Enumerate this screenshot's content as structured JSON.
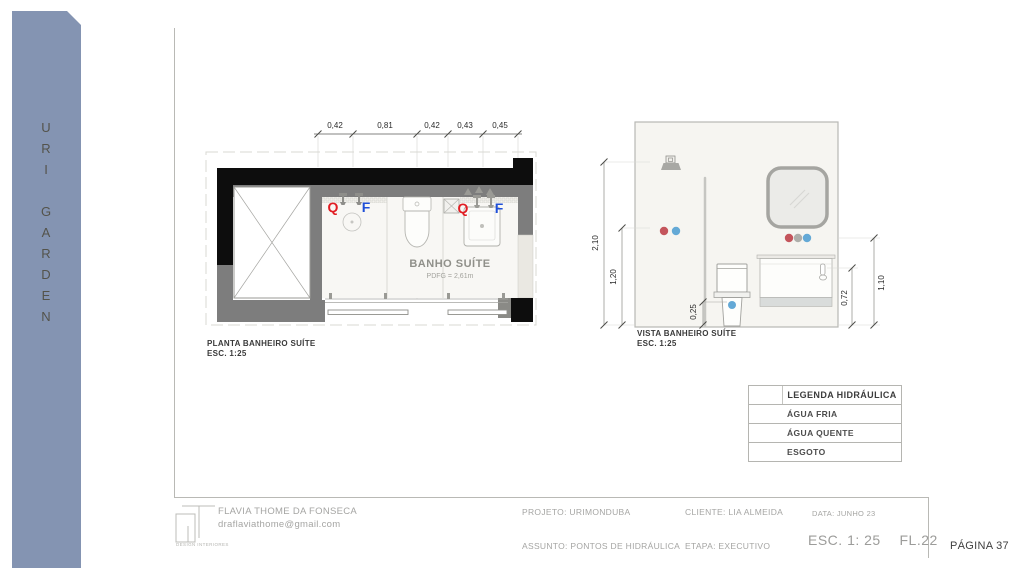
{
  "colors": {
    "sidebar_bg": "#8494b2",
    "agua_fria": "#64a9d6",
    "agua_quente": "#c4555c",
    "esgoto": "#f7d78c",
    "ponto_cinza": "#aeaeaa",
    "q_label": "#e11d23",
    "f_label": "#1f4fd8"
  },
  "sidebar": {
    "letters_top": [
      "U",
      "R",
      "I"
    ],
    "letters_bottom": [
      "G",
      "A",
      "R",
      "D",
      "E",
      "N"
    ]
  },
  "plan": {
    "caption": "PLANTA BANHEIRO SUÍTE",
    "scale": "ESC. 1:25",
    "room_name": "BANHO SUÍTE",
    "room_info": "PDFG = 2,61m",
    "dimensions": [
      "0,42",
      "0,81",
      "0,42",
      "0,43",
      "0,45"
    ],
    "points": [
      "Q",
      "F",
      "Q",
      "F"
    ]
  },
  "elevation": {
    "caption": "VISTA BANHEIRO SUÍTE",
    "scale": "ESC. 1:25",
    "dims": {
      "total_height": "2,10",
      "shower_point": "1,20",
      "toilet_point": "0,25",
      "counter_height": "0,72",
      "sink_point": "1,10"
    }
  },
  "legend": {
    "title": "LEGENDA HIDRÁULICA",
    "items": [
      {
        "label": "ÁGUA FRIA",
        "color": "#64a9d6"
      },
      {
        "label": "ÁGUA QUENTE",
        "color": "#c4555c"
      },
      {
        "label": "ESGOTO",
        "color": "#f7d78c"
      }
    ]
  },
  "titleblock": {
    "designer": "FLAVIA THOME DA FONSECA",
    "email": "draflaviathome@gmail.com",
    "logo_caption": "DESIGN INTERIORES",
    "projeto": "PROJETO: URIMONDUBA",
    "cliente": "CLIENTE:  LIA ALMEIDA",
    "assunto": "ASSUNTO: PONTOS DE HIDRÁULICA",
    "etapa": "ETAPA:  EXECUTIVO",
    "data": "DATA:  JUNHO 23",
    "escala": "ESC. 1: 25",
    "folha": "FL.22"
  },
  "page_number": "PÁGINA 37"
}
